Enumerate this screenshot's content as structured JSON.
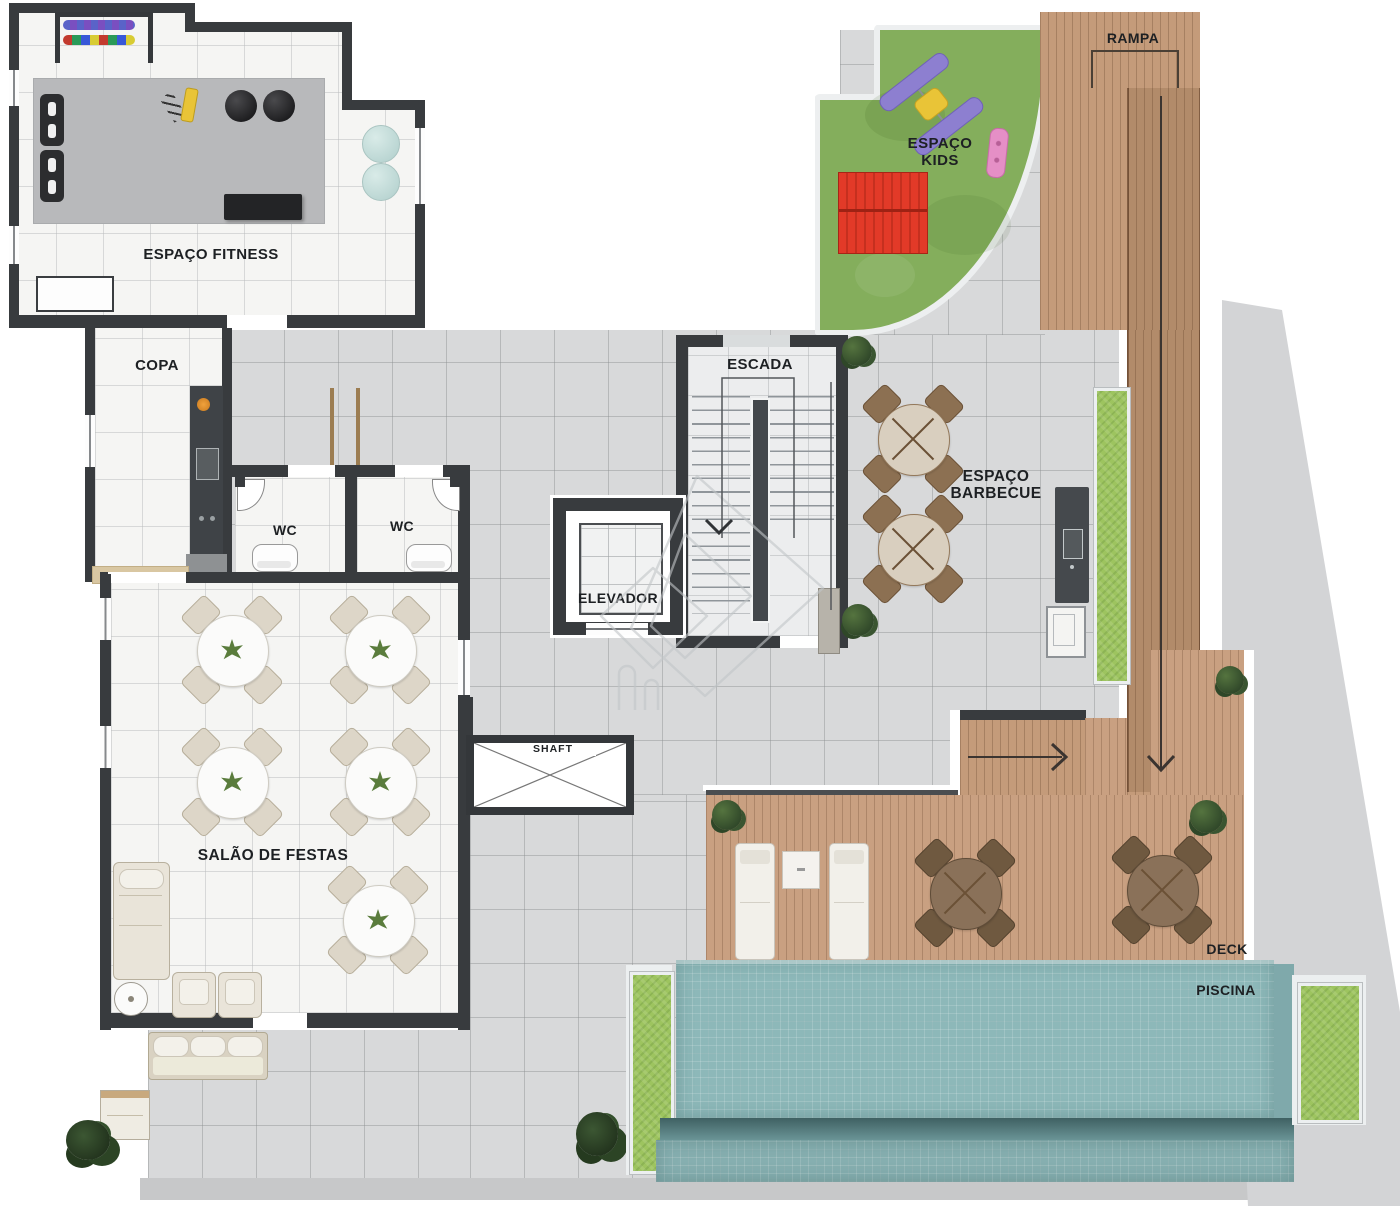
{
  "labels": {
    "fitness": "ESPAÇO FITNESS",
    "copa": "COPA",
    "wc_left": "WC",
    "wc_right": "WC",
    "salao": "SALÃO DE FESTAS",
    "escada": "ESCADA",
    "elevador": "ELEVADOR",
    "shaft": "SHAFT",
    "kids_line1": "ESPAÇO",
    "kids_line2": "KIDS",
    "barbecue_line1": "ESPAÇO",
    "barbecue_line2": "BARBECUE",
    "rampa": "RAMPA",
    "deck": "DECK",
    "piscina": "PISCINA"
  },
  "colors": {
    "wall": "#383b3e",
    "paving": "#d8d9da",
    "floor": "#f5f5f3",
    "mat": "#b8b9bb",
    "grass": "#84ae5c",
    "planter": "#9dc45f",
    "wood": "#c49b7a",
    "deck_wood": "#c9a081",
    "pool": "#8db8b9",
    "pool_shadow": "#3f6163",
    "red": "#e23a28",
    "purple": "#8d7fd0",
    "yellow": "#e9c437",
    "pink": "#e58fc6",
    "beige": "#e9e4d9",
    "label": "#1d2023",
    "watermark": "#c2c6c8"
  }
}
